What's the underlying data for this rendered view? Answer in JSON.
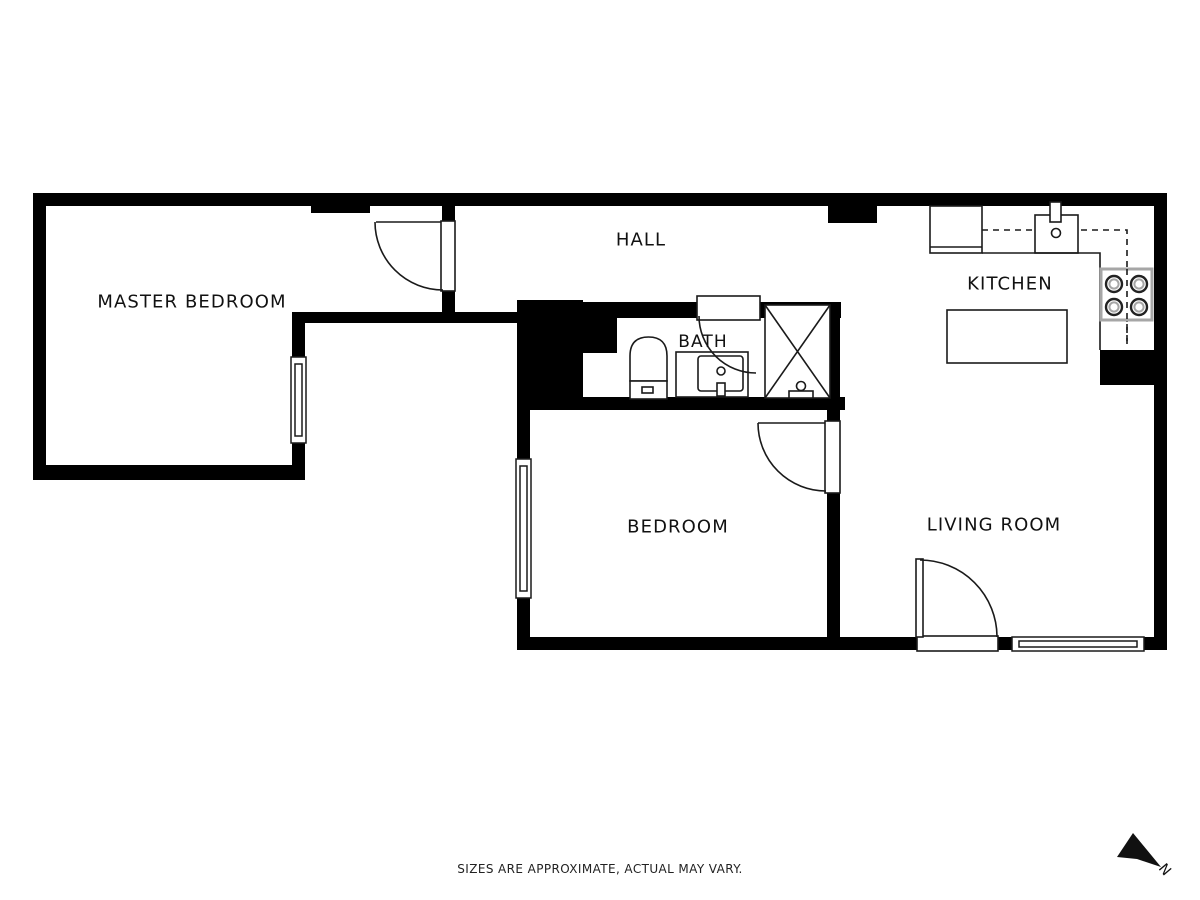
{
  "plan": {
    "rooms": [
      {
        "id": "master-bedroom",
        "label": "MASTER BEDROOM"
      },
      {
        "id": "hall",
        "label": "HALL"
      },
      {
        "id": "kitchen",
        "label": "KITCHEN"
      },
      {
        "id": "bath",
        "label": "BATH"
      },
      {
        "id": "bedroom",
        "label": "BEDROOM"
      },
      {
        "id": "living-room",
        "label": "LIVING ROOM"
      }
    ],
    "disclaimer": "SIZES ARE APPROXIMATE, ACTUAL MAY VARY.",
    "compass": {
      "label": "N"
    },
    "colors": {
      "background": "#ffffff",
      "wall": "#000000",
      "line": "#1a1a1a",
      "appliance_border": "#a6a6a6",
      "text": "#111111"
    }
  }
}
